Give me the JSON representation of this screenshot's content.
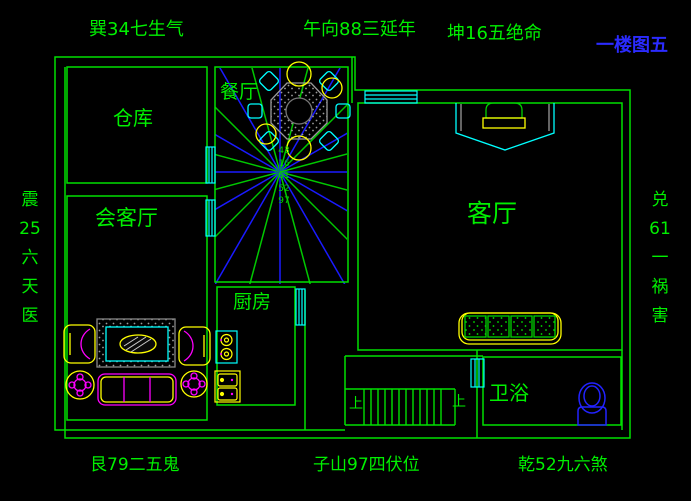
{
  "drawing": {
    "title": "一楼图五",
    "colors": {
      "background": "#000000",
      "wall_green": "#00e000",
      "text_green": "#00f000",
      "title_blue": "#2b2bff",
      "window_cyan": "#00ffff",
      "compass_blue": "#1a1aff",
      "compass_green": "#00c800",
      "furniture_yellow": "#ffff00",
      "furniture_magenta": "#ff00ff",
      "fixture_blue": "#2222ff"
    }
  },
  "compass": {
    "top_left": "巽34七生气",
    "top_center": "午向88三延年",
    "top_right": "坤16五绝命",
    "left_vertical": "震\n25\n六\n天\n医",
    "right_vertical": "兑\n61\n一\n祸\n害",
    "bottom_left": "艮79二五鬼",
    "bottom_center": "子山97四伏位",
    "bottom_right": "乾52九六煞",
    "center_numbers": "43\n16\n61\n52\n97"
  },
  "rooms": {
    "storage": "仓库",
    "dining": "餐厅",
    "reception": "会客厅",
    "kitchen": "厨房",
    "living": "客厅",
    "bathroom": "卫浴"
  },
  "stairs": {
    "up_label_left": "上",
    "up_label_right": "上"
  }
}
